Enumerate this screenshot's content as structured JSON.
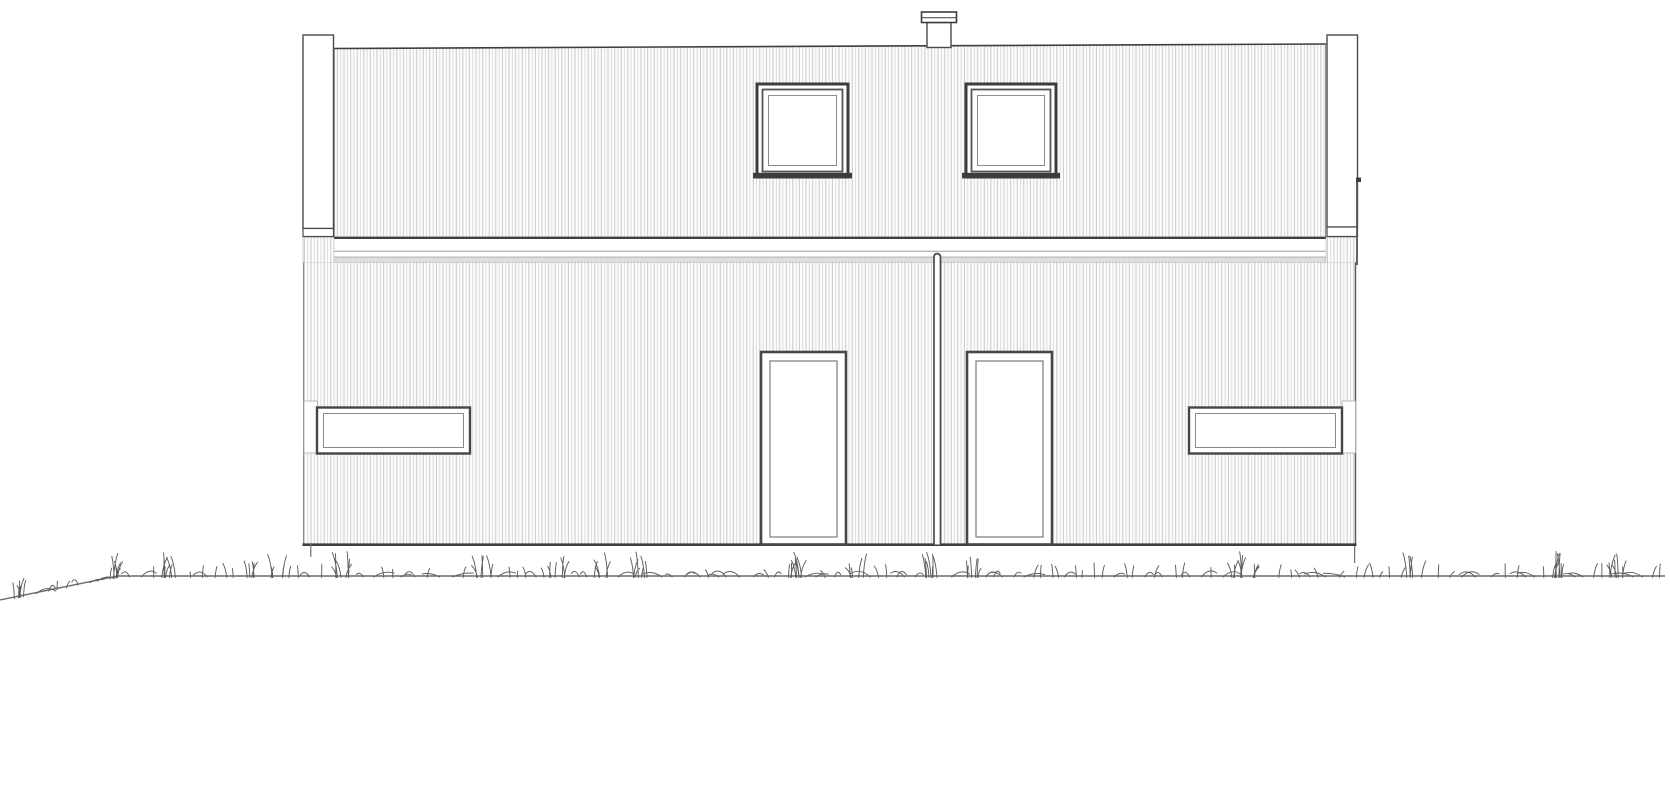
{
  "drawing": {
    "type": "architectural-elevation",
    "canvas": {
      "width": 1670,
      "height": 800
    },
    "colors": {
      "outline_dark": "#3e3e3e",
      "outline_mid": "#6e6e6e",
      "outline_light": "#9a9a9a",
      "cladding_line": "#c3c3c3",
      "cladding_line_alt": "#d4d4d4",
      "cladding_bg": "#fcfcfc",
      "fill_white": "#ffffff",
      "band_gray": "#dedede",
      "grass": "#5d5d5d",
      "ground": "#6a6a6a"
    },
    "shapes": [
      {
        "el": "path",
        "name": "ground-line",
        "attrs": {
          "d": "M0,600 L118,576 L1665,576",
          "stroke": "#6a6a6a",
          "stroke-width": "1.4",
          "fill": "none"
        }
      },
      {
        "el": "polygon",
        "name": "upper-wall-cladding",
        "attrs": {
          "points": "334,48.5 1326,44 1326,237 334,237",
          "fill": "url(#clad)",
          "stroke": "none"
        }
      },
      {
        "el": "path",
        "name": "roof-edge",
        "attrs": {
          "d": "M333.5,48.5 L1326.5,44",
          "stroke": "#3e3e3e",
          "stroke-width": "1.6",
          "fill": "none"
        }
      },
      {
        "el": "line",
        "name": "upper-wall-left-edge",
        "attrs": {
          "x1": "334.3",
          "y1": "48.5",
          "x2": "334.3",
          "y2": "237",
          "stroke": "#8a8a8a",
          "stroke-width": "1"
        }
      },
      {
        "el": "line",
        "name": "upper-wall-right-edge",
        "attrs": {
          "x1": "1325.6",
          "y1": "44",
          "x2": "1325.6",
          "y2": "237",
          "stroke": "#8a8a8a",
          "stroke-width": "1"
        }
      },
      {
        "el": "rect",
        "name": "band-fascia",
        "attrs": {
          "x": "333.5",
          "y": "238",
          "width": "992.5",
          "height": "19",
          "fill": "#ffffff",
          "stroke": "none"
        }
      },
      {
        "el": "line",
        "name": "band-top-edge",
        "attrs": {
          "x1": "333.5",
          "y1": "237.8",
          "x2": "1326",
          "y2": "237.8",
          "stroke": "#3e3e3e",
          "stroke-width": "2.4"
        }
      },
      {
        "el": "line",
        "name": "band-mid-line",
        "attrs": {
          "x1": "333.5",
          "y1": "251.3",
          "x2": "1326",
          "y2": "251.3",
          "stroke": "#9e9e9e",
          "stroke-width": "1"
        }
      },
      {
        "el": "rect",
        "name": "band-drip-edge",
        "attrs": {
          "x": "333.5",
          "y": "257",
          "width": "992.5",
          "height": "5.5",
          "fill": "#dedede",
          "stroke": "#999999",
          "stroke-width": "0.7"
        }
      },
      {
        "el": "rect",
        "name": "band-corner-left",
        "attrs": {
          "x": "303",
          "y": "237.5",
          "width": "31",
          "height": "25",
          "fill": "url(#clad)",
          "stroke": "#b5b5b5",
          "stroke-width": "0.6"
        }
      },
      {
        "el": "rect",
        "name": "band-corner-right",
        "attrs": {
          "x": "1326",
          "y": "237.5",
          "width": "31",
          "height": "25",
          "fill": "url(#clad)",
          "stroke": "#b5b5b5",
          "stroke-width": "0.6"
        }
      },
      {
        "el": "rect",
        "name": "lower-wall-cladding",
        "attrs": {
          "x": "303",
          "y": "262.5",
          "width": "1053",
          "height": "282",
          "fill": "url(#clad)",
          "stroke": "none"
        }
      },
      {
        "el": "line",
        "name": "lower-wall-left-edge",
        "attrs": {
          "x1": "303.5",
          "y1": "262.5",
          "x2": "303.5",
          "y2": "544",
          "stroke": "#8a8a8a",
          "stroke-width": "1"
        }
      },
      {
        "el": "line",
        "name": "lower-wall-right-edge",
        "attrs": {
          "x1": "1355.5",
          "y1": "262.5",
          "x2": "1355.5",
          "y2": "544",
          "stroke": "#5a5a5a",
          "stroke-width": "1.4"
        }
      },
      {
        "el": "line",
        "name": "base-edge",
        "attrs": {
          "x1": "302.5",
          "y1": "544.7",
          "x2": "1356.5",
          "y2": "544.7",
          "stroke": "#3e3e3e",
          "stroke-width": "2.6"
        }
      },
      {
        "el": "rect",
        "name": "left-post",
        "attrs": {
          "x": "303",
          "y": "35",
          "width": "30.5",
          "height": "193.5",
          "fill": "#ffffff",
          "stroke": "#4a4a4a",
          "stroke-width": "1.4"
        }
      },
      {
        "el": "rect",
        "name": "left-post-cap",
        "attrs": {
          "x": "303",
          "y": "228.5",
          "width": "30.5",
          "height": "8",
          "fill": "#ffffff",
          "stroke": "#4a4a4a",
          "stroke-width": "1.2"
        }
      },
      {
        "el": "rect",
        "name": "right-post",
        "attrs": {
          "x": "1327",
          "y": "35",
          "width": "30.5",
          "height": "192",
          "fill": "#ffffff",
          "stroke": "#4a4a4a",
          "stroke-width": "1.4"
        }
      },
      {
        "el": "rect",
        "name": "right-post-cap",
        "attrs": {
          "x": "1327",
          "y": "227",
          "width": "30.5",
          "height": "9.5",
          "fill": "#ffffff",
          "stroke": "#4a4a4a",
          "stroke-width": "1.2"
        }
      },
      {
        "el": "rect",
        "name": "chimney-body",
        "attrs": {
          "x": "927",
          "y": "22.5",
          "width": "24",
          "height": "25",
          "fill": "#ffffff",
          "stroke": "#4a4a4a",
          "stroke-width": "1.4"
        }
      },
      {
        "el": "rect",
        "name": "chimney-cap",
        "attrs": {
          "x": "921.5",
          "y": "12",
          "width": "35",
          "height": "10.5",
          "fill": "#ffffff",
          "stroke": "#3e3e3e",
          "stroke-width": "1.6"
        }
      },
      {
        "el": "line",
        "name": "chimney-cap-line",
        "attrs": {
          "x1": "921.5",
          "y1": "17.7",
          "x2": "956.5",
          "y2": "17.7",
          "stroke": "#3e3e3e",
          "stroke-width": "1"
        }
      },
      {
        "el": "rect",
        "name": "upper-window-left-outer",
        "attrs": {
          "x": "757",
          "y": "84",
          "width": "91",
          "height": "93",
          "fill": "#ffffff",
          "stroke": "#3c3c3c",
          "stroke-width": "3"
        }
      },
      {
        "el": "rect",
        "name": "upper-window-left-mid",
        "attrs": {
          "x": "762.5",
          "y": "89.5",
          "width": "80",
          "height": "82",
          "fill": "none",
          "stroke": "#555555",
          "stroke-width": "1.8"
        }
      },
      {
        "el": "rect",
        "name": "upper-window-left-inner",
        "attrs": {
          "x": "768.5",
          "y": "95.5",
          "width": "68",
          "height": "70",
          "fill": "none",
          "stroke": "#8c8c8c",
          "stroke-width": "1"
        }
      },
      {
        "el": "rect",
        "name": "upper-window-left-sill",
        "attrs": {
          "x": "753",
          "y": "172.8",
          "width": "99",
          "height": "5.6",
          "fill": "#3c3c3c",
          "stroke": "none"
        }
      },
      {
        "el": "rect",
        "name": "upper-window-right-outer",
        "attrs": {
          "x": "966",
          "y": "84",
          "width": "90",
          "height": "93",
          "fill": "#ffffff",
          "stroke": "#3c3c3c",
          "stroke-width": "3"
        }
      },
      {
        "el": "rect",
        "name": "upper-window-right-mid",
        "attrs": {
          "x": "971.5",
          "y": "89.5",
          "width": "79",
          "height": "82",
          "fill": "none",
          "stroke": "#555555",
          "stroke-width": "1.8"
        }
      },
      {
        "el": "rect",
        "name": "upper-window-right-inner",
        "attrs": {
          "x": "977.5",
          "y": "95.5",
          "width": "67",
          "height": "70",
          "fill": "none",
          "stroke": "#8c8c8c",
          "stroke-width": "1"
        }
      },
      {
        "el": "rect",
        "name": "upper-window-right-sill",
        "attrs": {
          "x": "962",
          "y": "172.8",
          "width": "98",
          "height": "5.6",
          "fill": "#3c3c3c",
          "stroke": "none"
        }
      },
      {
        "el": "rect",
        "name": "door-left-outer",
        "attrs": {
          "x": "761",
          "y": "352",
          "width": "85",
          "height": "192.5",
          "fill": "#ffffff",
          "stroke": "#474747",
          "stroke-width": "2.6"
        }
      },
      {
        "el": "rect",
        "name": "door-left-inner",
        "attrs": {
          "x": "770",
          "y": "361",
          "width": "67",
          "height": "176",
          "fill": "none",
          "stroke": "#7a7a7a",
          "stroke-width": "1.2"
        }
      },
      {
        "el": "rect",
        "name": "door-right-outer",
        "attrs": {
          "x": "967",
          "y": "352",
          "width": "85",
          "height": "192.5",
          "fill": "#ffffff",
          "stroke": "#474747",
          "stroke-width": "2.6"
        }
      },
      {
        "el": "rect",
        "name": "door-right-inner",
        "attrs": {
          "x": "976",
          "y": "361",
          "width": "67",
          "height": "176",
          "fill": "none",
          "stroke": "#7a7a7a",
          "stroke-width": "1.2"
        }
      },
      {
        "el": "path",
        "name": "party-wall-divider",
        "attrs": {
          "d": "M934,544.5 L934,257.5 Q934,253.6 937.25,253.6 Q940.5,253.6 940.5,257.5 L940.5,544.5",
          "fill": "#ffffff",
          "stroke": "#4a4a4a",
          "stroke-width": "1.7"
        }
      },
      {
        "el": "rect",
        "name": "lower-window-left-pad",
        "attrs": {
          "x": "304",
          "y": "401",
          "width": "13.5",
          "height": "52",
          "fill": "#ffffff",
          "stroke": "#ababab",
          "stroke-width": "0.8"
        }
      },
      {
        "el": "rect",
        "name": "lower-window-left-outer",
        "attrs": {
          "x": "317",
          "y": "407.5",
          "width": "153",
          "height": "46",
          "fill": "#ffffff",
          "stroke": "#454545",
          "stroke-width": "2.4"
        }
      },
      {
        "el": "rect",
        "name": "lower-window-left-inner",
        "attrs": {
          "x": "323.5",
          "y": "413.5",
          "width": "140",
          "height": "34",
          "fill": "none",
          "stroke": "#8a8a8a",
          "stroke-width": "1"
        }
      },
      {
        "el": "rect",
        "name": "lower-window-right-pad",
        "attrs": {
          "x": "1342",
          "y": "401",
          "width": "13.5",
          "height": "52",
          "fill": "#ffffff",
          "stroke": "#ababab",
          "stroke-width": "0.8"
        }
      },
      {
        "el": "rect",
        "name": "lower-window-right-outer",
        "attrs": {
          "x": "1189",
          "y": "407.5",
          "width": "153",
          "height": "46",
          "fill": "#ffffff",
          "stroke": "#454545",
          "stroke-width": "2.4"
        }
      },
      {
        "el": "rect",
        "name": "lower-window-right-inner",
        "attrs": {
          "x": "1195.5",
          "y": "413.5",
          "width": "140",
          "height": "34",
          "fill": "none",
          "stroke": "#8a8a8a",
          "stroke-width": "1"
        }
      },
      {
        "el": "line",
        "name": "right-edge-shadow",
        "attrs": {
          "x1": "1357",
          "y1": "182",
          "x2": "1357",
          "y2": "265",
          "stroke": "#555555",
          "stroke-width": "1.8"
        }
      },
      {
        "el": "rect",
        "name": "right-edge-tick",
        "attrs": {
          "x": "1356",
          "y": "177.5",
          "width": "5",
          "height": "4.5",
          "fill": "#3e3e3e",
          "stroke": "none"
        }
      },
      {
        "el": "line",
        "name": "foundation-peg-left",
        "attrs": {
          "x1": "310.8",
          "y1": "544",
          "x2": "310.8",
          "y2": "557",
          "stroke": "#707070",
          "stroke-width": "1.2"
        }
      },
      {
        "el": "line",
        "name": "foundation-peg-right",
        "attrs": {
          "x1": "1354.6",
          "y1": "546",
          "x2": "1354.6",
          "y2": "563",
          "stroke": "#707070",
          "stroke-width": "1.2"
        }
      }
    ],
    "grass": {
      "x_start": 10,
      "x_end": 1662,
      "slope": {
        "x0": 0,
        "y0": 600,
        "x1": 118,
        "y1": 576
      },
      "flat_y": 576,
      "clump_period": 155,
      "seed": 11,
      "stroke_width": 0.95
    }
  }
}
